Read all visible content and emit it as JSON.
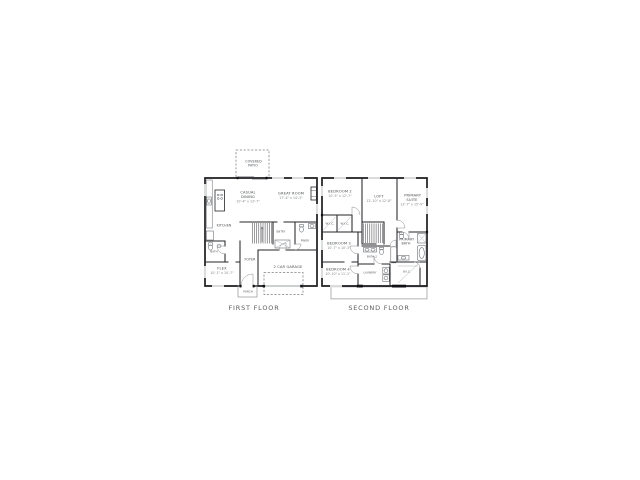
{
  "first_floor": {
    "title": "FIRST FLOOR",
    "rooms": {
      "covered_patio": {
        "name": "COVERED PATIO"
      },
      "casual_dining": {
        "name": "CASUAL DINING",
        "dims": "10'-4\" x 13'-7\""
      },
      "great_room": {
        "name": "GREAT ROOM",
        "dims": "17'-4\" x 14'-3\""
      },
      "kitchen": {
        "name": "KITCHEN"
      },
      "bath": {
        "name": "BATH"
      },
      "flex": {
        "name": "FLEX",
        "dims": "10'-1\" x 10'-7\""
      },
      "foyer": {
        "name": "FOYER"
      },
      "entry": {
        "name": "ENTRY"
      },
      "powder": {
        "name": "PWDR"
      },
      "garage": {
        "name": "2 CAR GARAGE"
      },
      "porch": {
        "name": "PORCH"
      }
    }
  },
  "second_floor": {
    "title": "SECOND FLOOR",
    "rooms": {
      "bedroom2": {
        "name": "BEDROOM 2",
        "dims": "10'-5\" x 12'-7\""
      },
      "loft": {
        "name": "LOFT",
        "dims": "12'-10\" x 12'-8\""
      },
      "primary_suite": {
        "name": "PRIMARY SUITE",
        "dims": "13'-7\" x 15'-9\""
      },
      "wic_a": {
        "name": "W.I.C."
      },
      "wic_b": {
        "name": "W.I.C."
      },
      "bedroom3": {
        "name": "BEDROOM 3",
        "dims": "10'-7\" x 10'-3\""
      },
      "primary_bath": {
        "name": "PRIMARY BATH"
      },
      "bath2": {
        "name": "BATH 2"
      },
      "bedroom4": {
        "name": "BEDROOM 4",
        "dims": "10'-10\" x 11'-2\""
      },
      "laundry": {
        "name": "LAUNDRY"
      },
      "wic": {
        "name": "W.I.C."
      }
    }
  },
  "colors": {
    "wall": "#1d1d1f",
    "lightline": "#8f9396",
    "label": "#4a4d50",
    "title": "#5a5d60"
  }
}
